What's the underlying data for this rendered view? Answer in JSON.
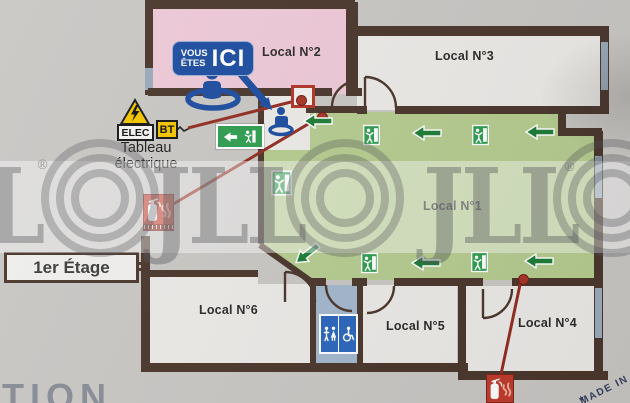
{
  "plan": {
    "floor_label": "1er Étage",
    "rooms": [
      {
        "label": "Local N°2"
      },
      {
        "label": "Local N°3"
      },
      {
        "label": "Local N°1"
      },
      {
        "label": "Local N°6"
      },
      {
        "label": "Local N°5"
      },
      {
        "label": "Local N°4"
      }
    ],
    "you_are_here": {
      "line1": "VOUS",
      "line2": "ÊTES",
      "line3": "ICI"
    },
    "electrical": {
      "elec_label": "ELEC",
      "bt_label": "BT",
      "caption_line1": "Tableau",
      "caption_line2": "électrique"
    }
  },
  "watermark": {
    "brand": "JLL",
    "brand_partial": "L",
    "registered": "®",
    "bottom_left_fragment": "TION",
    "origin_stamp": "MADE IN"
  },
  "colors": {
    "background": "#c9c7c4",
    "wall": "#4a372d",
    "room_pink": "#eec9d7",
    "room_white": "#eceae7",
    "corridor_green": "#b5cc90",
    "arrow_green": "#1e7d36",
    "exit_sign_green": "#2f9e50",
    "marker_blue": "#1c4da0",
    "alert_red": "#b23527",
    "toilet_blue": "#2b66bd",
    "window_gray": "#9aabba"
  }
}
